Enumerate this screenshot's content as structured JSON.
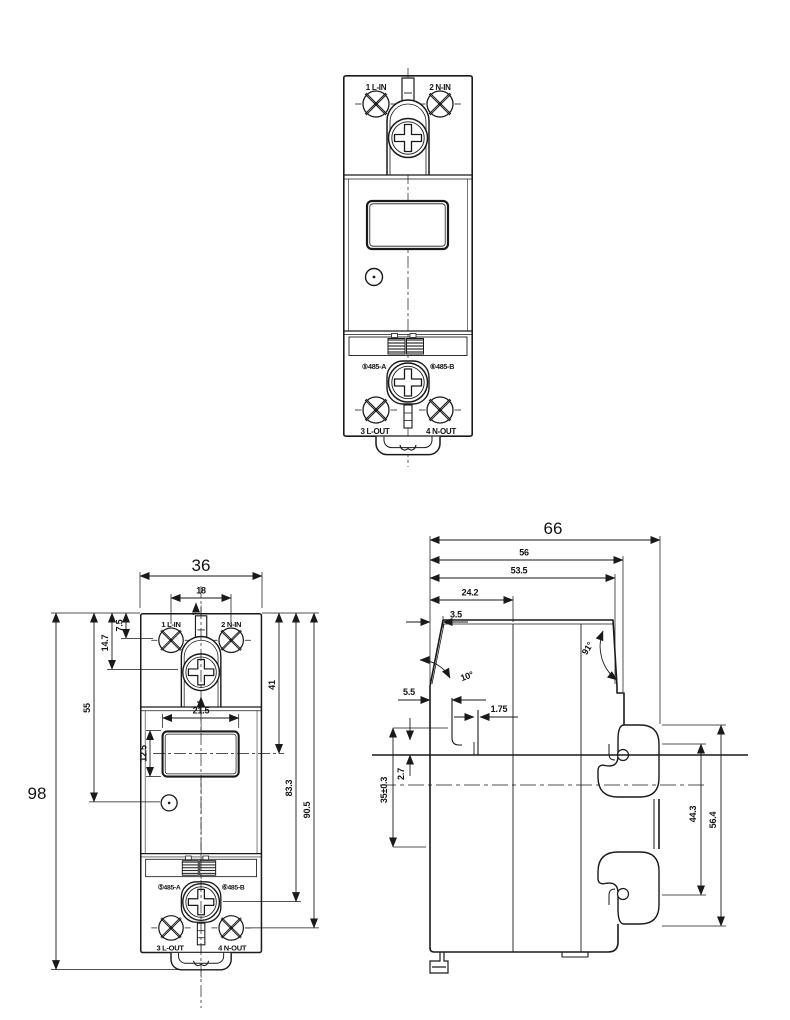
{
  "front_labels": {
    "in1": "1 L-IN",
    "in2": "2 N-IN",
    "rs_a": "⑤485-A",
    "rs_b": "⑥485-B",
    "out3": "3 L-OUT",
    "out4": "4 N-OUT"
  },
  "front_dims": {
    "width": "36",
    "pitch": "18",
    "height": "98",
    "body": "55",
    "screw_center": "14.7",
    "terminal_center": "7.5",
    "display_center": "41",
    "screw_out_center": "83.3",
    "terminal_out_center": "90.5",
    "display_w": "21.5",
    "display_h": "12.5"
  },
  "side_dims": {
    "depth": "66",
    "d56": "56",
    "d53_5": "53.5",
    "d24_2": "24.2",
    "d3_5": "3.5",
    "angle_front": "10°",
    "angle_back": "91°",
    "d5_5": "5.5",
    "d1_75": "1.75",
    "d2_7": "2.7",
    "rail": "35±0.3",
    "d44_3": "44.3",
    "d56_4": "56.4"
  }
}
